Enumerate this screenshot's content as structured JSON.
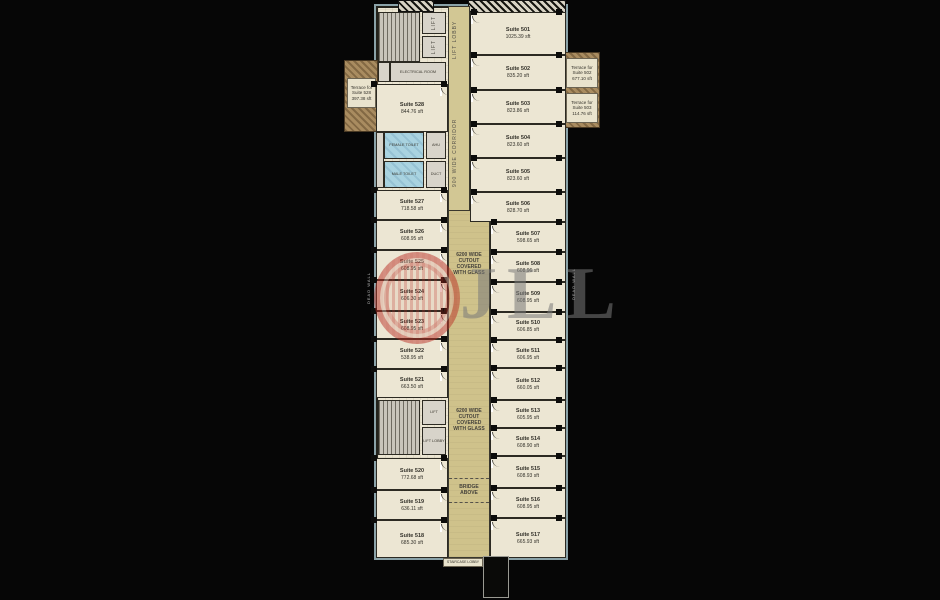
{
  "watermark": {
    "letters": "JLL",
    "ring_color": "#ba3026",
    "letter_color": "#7a7a7a"
  },
  "colors": {
    "background": "#060606",
    "floor": "#ece6d3",
    "corridor": "#d2c794",
    "terrace": "#a98c60",
    "toilet": "#a9d3e0",
    "wall": "#23221b",
    "exterior_trim": "#8aa2a8"
  },
  "plan": {
    "lift_lobby_vertical": "LIFT LOBBY",
    "corridor_label": "900 WIDE CORRIDOR",
    "cutout_label_upper": "6200 WIDE CUTOUT COVERED WITH GLASS",
    "cutout_label_lower": "6200 WIDE CUTOUT COVERED WITH GLASS",
    "bridge_label": "BRIDGE ABOVE",
    "staircase_lobby_label": "STAIRCASE LOBBY",
    "side_label_left": "DEAD WALL",
    "side_label_right": "DEAD WALL",
    "rooms": {
      "lift_a": "LIFT",
      "lift_b": "LIFT",
      "lift_c": "LIFT",
      "lift_lobby_small": "LIFT LOBBY",
      "electrical": "ELECTRICAL ROOM",
      "female_toilet": "FEMALE TOILET",
      "male_toilet": "MALE TOILET",
      "ahu": "AHU",
      "duct": "DUCT"
    }
  },
  "terraces": [
    {
      "name": "Terrace for Suite 528",
      "area": "397.38 sft"
    },
    {
      "name": "Terrace for Suite 502",
      "area": "677.10 sft"
    },
    {
      "name": "Terrace for Suite 503",
      "area": "114.76 sft"
    }
  ],
  "suites_right": [
    {
      "name": "Suite 501",
      "area": "1025.39 sft"
    },
    {
      "name": "Suite 502",
      "area": "835.20 sft"
    },
    {
      "name": "Suite 503",
      "area": "823.86 sft"
    },
    {
      "name": "Suite 504",
      "area": "823.60 sft"
    },
    {
      "name": "Suite 505",
      "area": "823.60 sft"
    },
    {
      "name": "Suite 506",
      "area": "828.70 sft"
    },
    {
      "name": "Suite 507",
      "area": "598.65 sft"
    },
    {
      "name": "Suite 508",
      "area": "608.96 sft"
    },
    {
      "name": "Suite 509",
      "area": "608.95 sft"
    },
    {
      "name": "Suite 510",
      "area": "606.85 sft"
    },
    {
      "name": "Suite 511",
      "area": "606.95 sft"
    },
    {
      "name": "Suite 512",
      "area": "660.05 sft"
    },
    {
      "name": "Suite 513",
      "area": "605.95 sft"
    },
    {
      "name": "Suite 514",
      "area": "608.90 sft"
    },
    {
      "name": "Suite 515",
      "area": "608.93 sft"
    },
    {
      "name": "Suite 516",
      "area": "608.95 sft"
    },
    {
      "name": "Suite 517",
      "area": "665.93 sft"
    }
  ],
  "suites_left": [
    {
      "name": "Suite 528",
      "area": "844.76 sft"
    },
    {
      "name": "Suite 527",
      "area": "718.58 sft"
    },
    {
      "name": "Suite 526",
      "area": "608.95 sft"
    },
    {
      "name": "Suite 525",
      "area": "608.95 sft"
    },
    {
      "name": "Suite 524",
      "area": "606.30 sft"
    },
    {
      "name": "Suite 523",
      "area": "608.95 sft"
    },
    {
      "name": "Suite 522",
      "area": "538.95 sft"
    },
    {
      "name": "Suite 521",
      "area": "663.50 sft"
    },
    {
      "name": "Suite 520",
      "area": "772.68 sft"
    },
    {
      "name": "Suite 519",
      "area": "636.11 sft"
    },
    {
      "name": "Suite 518",
      "area": "685.30 sft"
    }
  ]
}
